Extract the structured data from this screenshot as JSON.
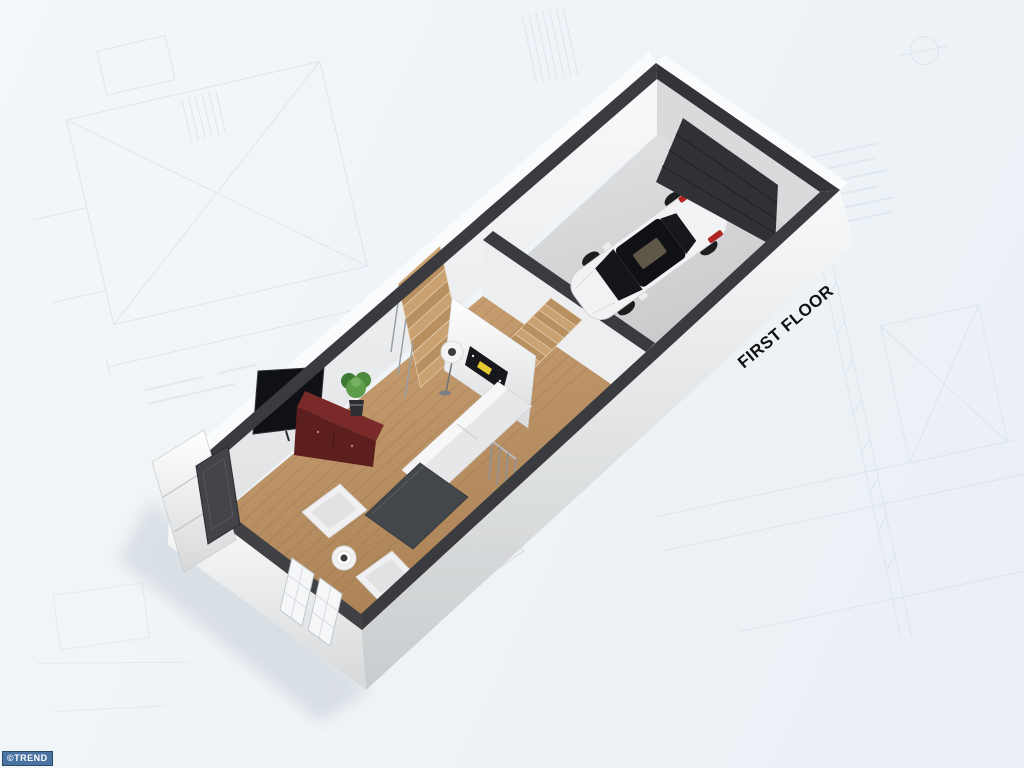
{
  "labels": {
    "floor_label": "FIRST FLOOR",
    "watermark": "©TREND"
  },
  "scene": {
    "view": "3d-isometric-floor-plan",
    "rooms": [
      "living-room",
      "garage"
    ],
    "objects": [
      "white-car",
      "garage-door",
      "staircase",
      "partition-wall",
      "wall-art",
      "floor-lamp",
      "flat-tv",
      "tv-cabinet",
      "potted-plant",
      "sofa",
      "coffee-table",
      "armchairs",
      "side-table",
      "entry-door",
      "entry-steps",
      "front-windows",
      "stair-railing"
    ]
  },
  "colors": {
    "background": "#eef3f8",
    "blueprint_line": "#ccd8e2",
    "wall_top": "#3a3b3f",
    "wall_exterior": "#f4f5f6",
    "wood_floor": "#c49a6c",
    "garage_floor": "#d6d7d9",
    "cabinet": "#6b2523",
    "car_body": "#f2f3f4",
    "car_tail_light": "#b02424",
    "art_accent": "#e8c832",
    "watermark_bg": "#4a72a2",
    "label_text": "#111111"
  }
}
